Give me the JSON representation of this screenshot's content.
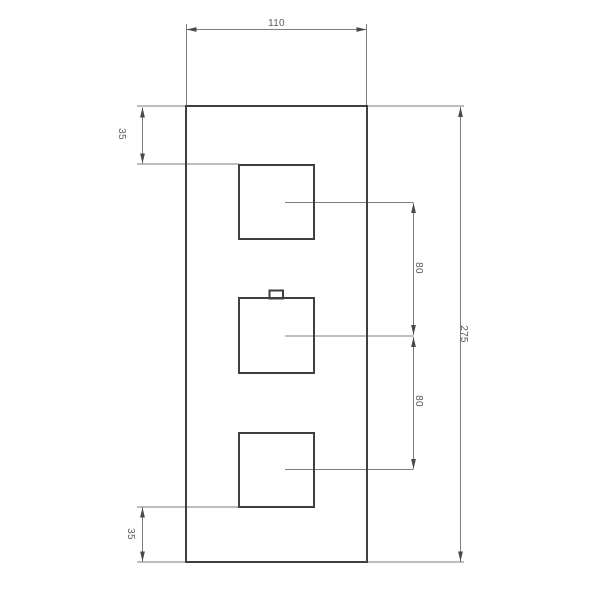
{
  "drawing": {
    "type": "technical-dimension-drawing",
    "view": "front elevation of a rectangular plate with three square controls (middle control has a small top tab)",
    "colors": {
      "background": "#ffffff",
      "object_line": "#3f3f3f",
      "dimension_line": "#7d7d7d",
      "arrow": "#4a4a4a",
      "text": "#5a5a5a"
    },
    "labels": {
      "width": "110",
      "height": "275",
      "top_offset": "35",
      "upper_spacing": "80",
      "lower_spacing": "80",
      "bottom_offset": "35"
    }
  }
}
